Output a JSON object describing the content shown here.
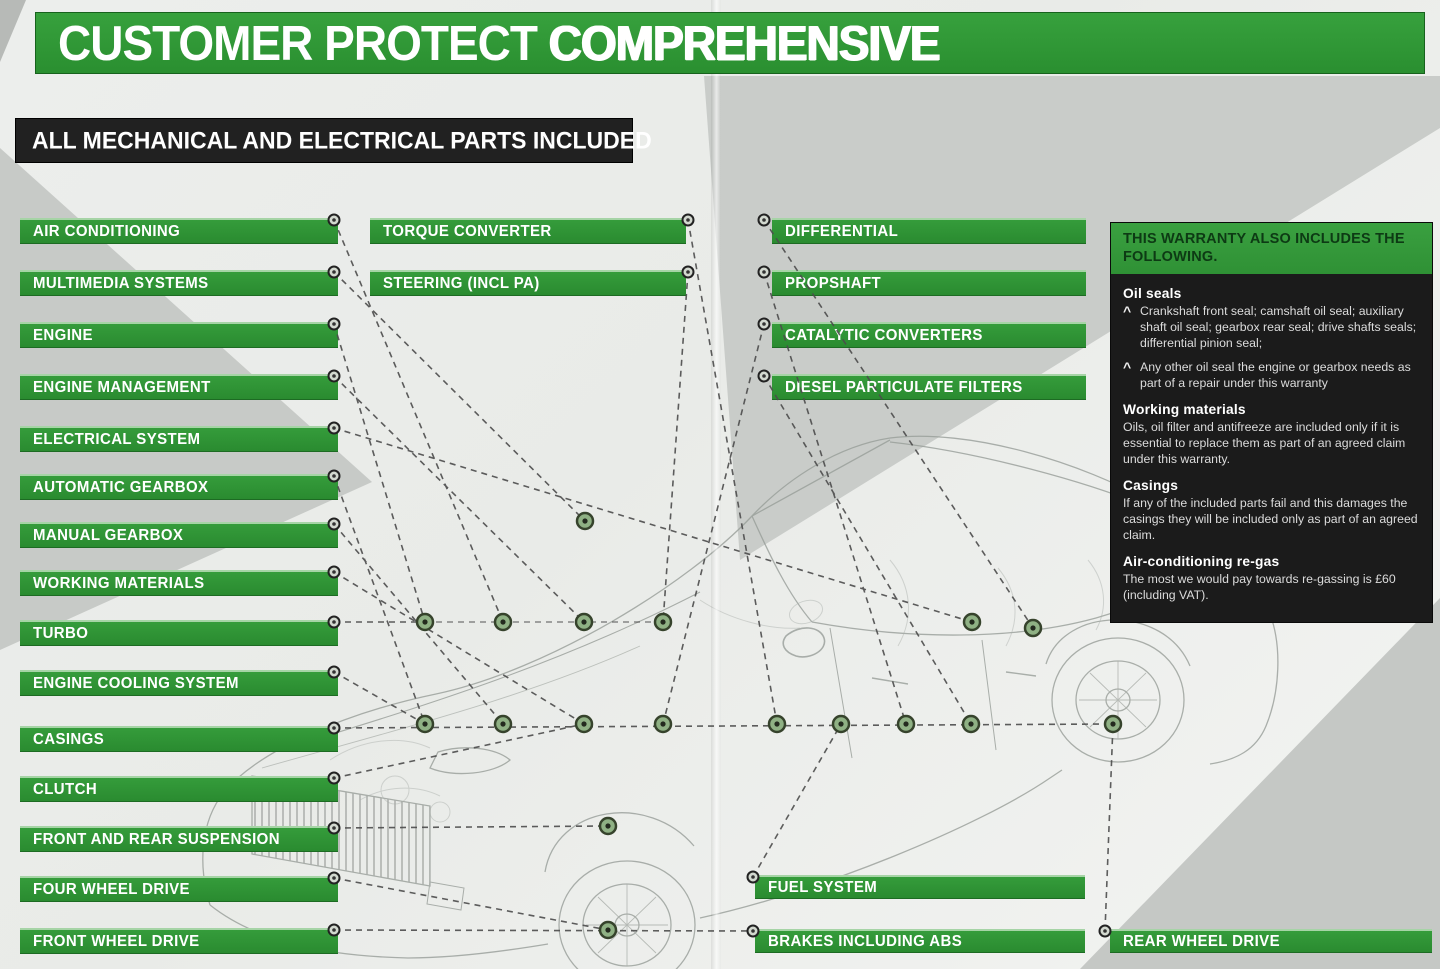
{
  "header": {
    "title_regular": "CUSTOMER PROTECT ",
    "title_bold": "COMPREHENSIVE",
    "subtitle": "ALL MECHANICAL AND ELECTRICAL PARTS INCLUDED"
  },
  "parts": {
    "left": [
      "AIR CONDITIONING",
      "MULTIMEDIA SYSTEMS",
      "ENGINE",
      "ENGINE MANAGEMENT",
      "ELECTRICAL SYSTEM",
      "AUTOMATIC GEARBOX",
      "MANUAL GEARBOX",
      "WORKING MATERIALS",
      "TURBO",
      "ENGINE COOLING SYSTEM",
      "CASINGS",
      "CLUTCH",
      "FRONT AND REAR SUSPENSION",
      "FOUR WHEEL DRIVE",
      "FRONT WHEEL DRIVE"
    ],
    "middle": [
      "TORQUE CONVERTER",
      "STEERING (INCL PA)"
    ],
    "right": [
      "DIFFERENTIAL",
      "PROPSHAFT",
      "CATALYTIC CONVERTERS",
      "DIESEL PARTICULATE FILTERS"
    ],
    "bottom": [
      "FUEL SYSTEM",
      "BRAKES INCLUDING ABS",
      "REAR WHEEL DRIVE"
    ]
  },
  "sidebar": {
    "title": "THIS WARRANTY ALSO INCLUDES THE FOLLOWING.",
    "bullet_char": "^",
    "sections": [
      {
        "heading": "Oil seals",
        "bullets": [
          "Crankshaft front seal; camshaft oil seal; auxiliary shaft oil seal; gearbox rear seal; drive shafts seals; differential pinion seal;",
          "Any other oil seal the engine or gearbox needs as part of a repair under this warranty"
        ]
      },
      {
        "heading": "Working materials",
        "body": "Oils, oil filter and antifreeze are included only if it is essential to replace them as part of an agreed claim under this warranty."
      },
      {
        "heading": "Casings",
        "body": "If any of the included parts fail and this damages the casings they will be included only as part of an agreed claim."
      },
      {
        "heading": "Air-conditioning re-gas",
        "body": "The most we would pay towards re-gassing is £60 (including VAT)."
      }
    ]
  },
  "colors": {
    "brand_green": "#2f9a35",
    "panel_black": "#1b1b1b",
    "label_text": "#ffffff",
    "sidebar_header_text": "#0d3a14"
  }
}
